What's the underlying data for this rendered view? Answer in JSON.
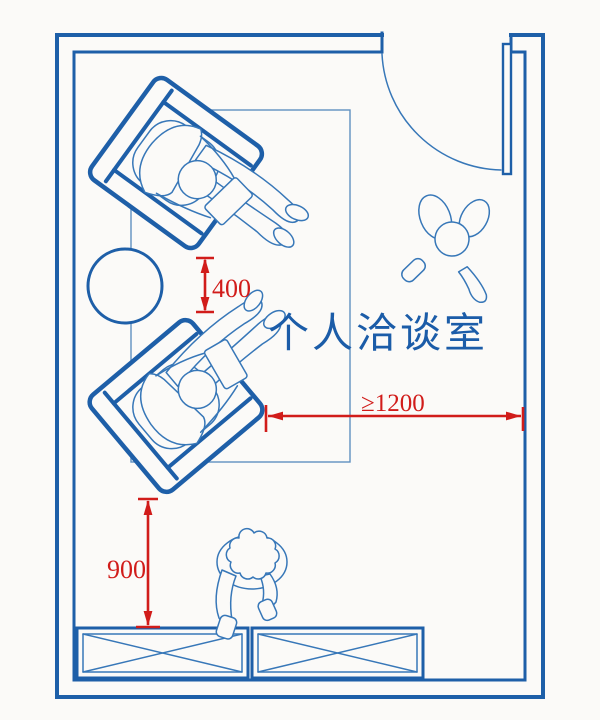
{
  "room": {
    "label": "个人洽谈室"
  },
  "dims": {
    "d400": "400",
    "d1200": "≥1200",
    "d900": "900"
  },
  "objects": {
    "armchair_count": 2,
    "seated_person_count": 2,
    "standing_person_count": 2,
    "side_table": "round-side-table",
    "rug": "area-rug",
    "door": "swing-door",
    "cabinet_count": 2
  },
  "colors": {
    "wall_blue": "#1e5fa8",
    "figure_blue": "#3777b8",
    "rug_blue": "#6090c0",
    "dimension_red": "#d11c1a",
    "label_blue": "#1b5ca8",
    "background": "#fbfaf8"
  }
}
